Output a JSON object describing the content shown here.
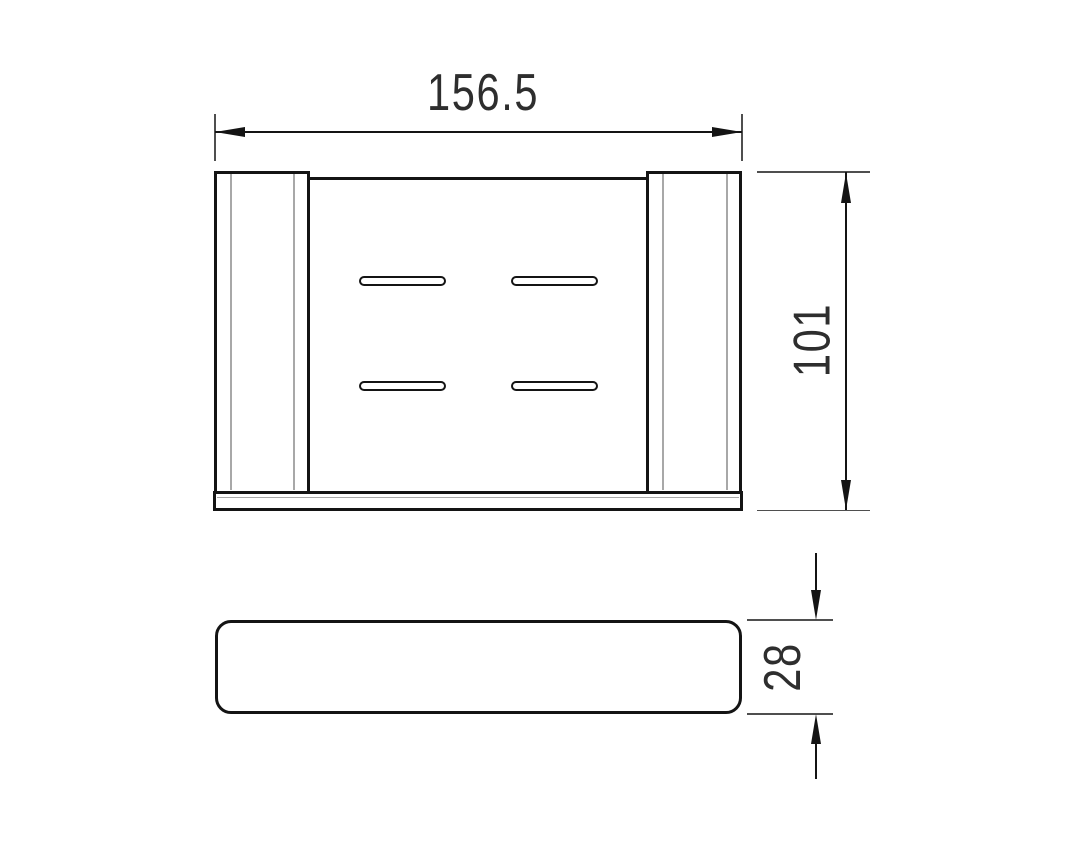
{
  "drawing": {
    "type": "technical-drawing",
    "subject": "soap-dish-shelf-two-views",
    "background_color": "#ffffff",
    "outline_color": "#141414",
    "inner_line_color": "#a8a8a8",
    "extension_line_color": "#4f4f4f",
    "text_color": "#2e2e2e",
    "views": {
      "top_view": {
        "name": "top view",
        "slot_count": 4,
        "bracket_count": 2
      },
      "front_view": {
        "name": "front view"
      }
    },
    "dimensions": {
      "width": {
        "value": "156.5",
        "orientation": "horizontal",
        "applies_to": "top view overall width"
      },
      "depth": {
        "value": "101",
        "orientation": "vertical",
        "applies_to": "top view overall depth"
      },
      "height": {
        "value": "28",
        "orientation": "vertical",
        "applies_to": "front view overall height"
      }
    }
  }
}
